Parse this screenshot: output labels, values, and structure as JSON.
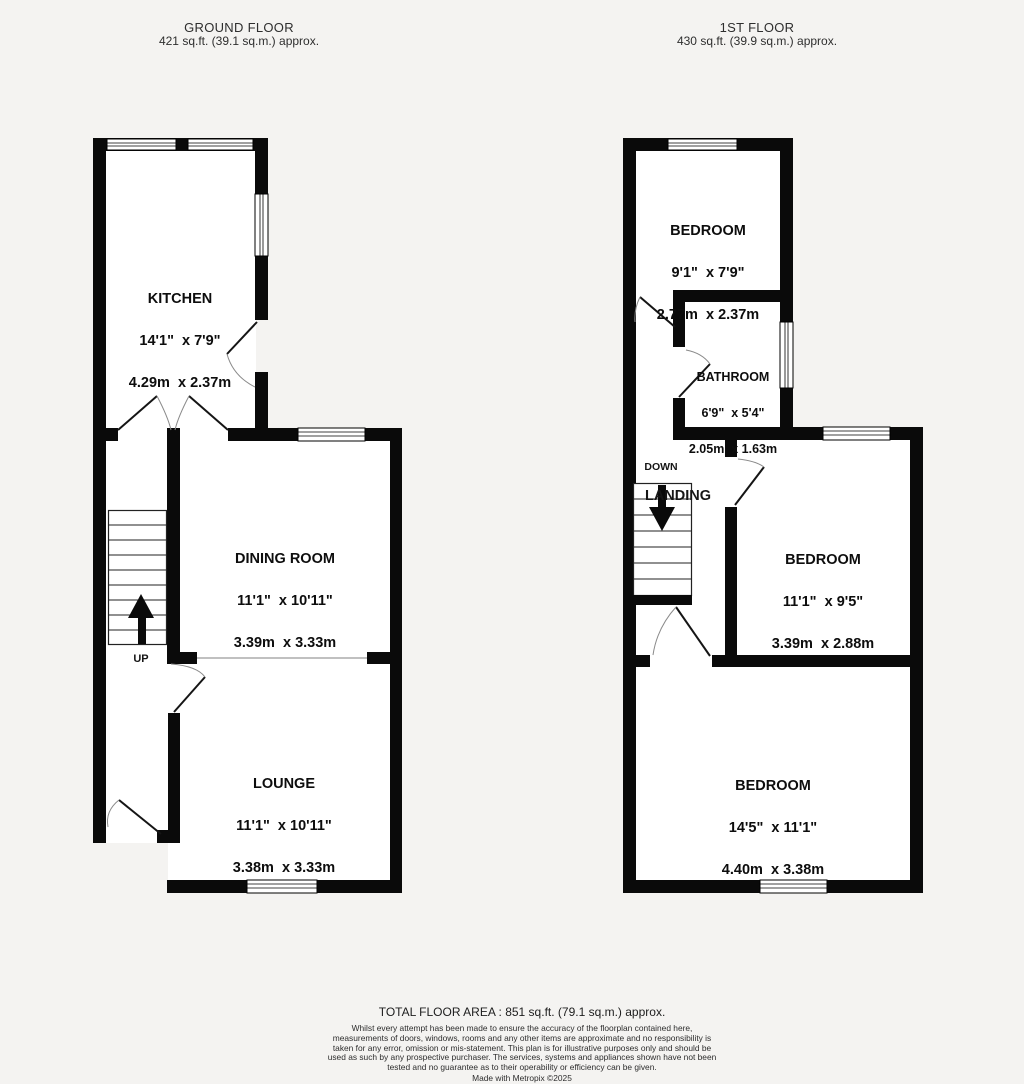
{
  "colors": {
    "wall": "#0a0a0a",
    "background": "#f4f3f1",
    "room_fill": "#ffffff"
  },
  "floors": {
    "ground": {
      "title": "GROUND FLOOR",
      "area": "421 sq.ft. (39.1 sq.m.) approx."
    },
    "first": {
      "title": "1ST FLOOR",
      "area": "430 sq.ft. (39.9 sq.m.) approx."
    }
  },
  "rooms": {
    "kitchen": {
      "name": "KITCHEN",
      "imperial": "14'1\"  x 7'9\"",
      "metric": "4.29m  x 2.37m"
    },
    "dining": {
      "name": "DINING ROOM",
      "imperial": "11'1\"  x 10'11\"",
      "metric": "3.39m  x 3.33m"
    },
    "lounge": {
      "name": "LOUNGE",
      "imperial": "11'1\"  x 10'11\"",
      "metric": "3.38m  x 3.33m"
    },
    "bedroom1": {
      "name": "BEDROOM",
      "imperial": "9'1\"  x 7'9\"",
      "metric": "2.77m  x 2.37m"
    },
    "bathroom": {
      "name": "BATHROOM",
      "imperial": "6'9\"  x 5'4\"",
      "metric": "2.05m  x 1.63m"
    },
    "bedroom2": {
      "name": "BEDROOM",
      "imperial": "11'1\"  x 9'5\"",
      "metric": "3.39m  x 2.88m"
    },
    "bedroom3": {
      "name": "BEDROOM",
      "imperial": "14'5\"  x 11'1\"",
      "metric": "4.40m  x 3.38m"
    }
  },
  "stairs": {
    "up": "UP",
    "down": "DOWN",
    "landing": "LANDING"
  },
  "footer": {
    "total": "TOTAL FLOOR AREA : 851 sq.ft. (79.1 sq.m.) approx.",
    "disclaimer": "Whilst every attempt has been made to ensure the accuracy of the floorplan contained here, measurements of doors, windows, rooms and any other items are approximate and no responsibility is taken for any error, omission or mis-statement. This plan is for illustrative purposes only and should be used as such by any prospective purchaser. The services, systems and appliances shown have not been tested and no guarantee as to their operability or efficiency can be given.",
    "credit": "Made with Metropix ©2025"
  }
}
